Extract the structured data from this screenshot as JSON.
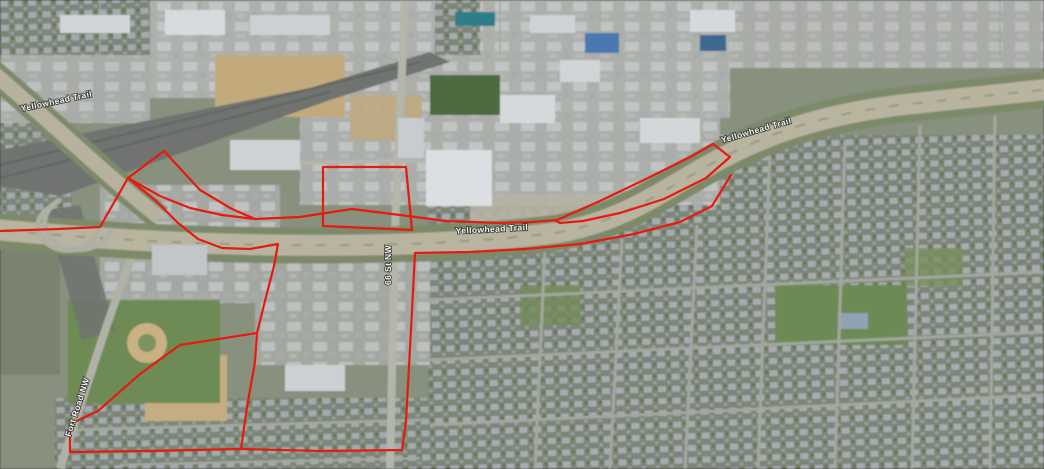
{
  "map": {
    "view_type": "satellite-aerial-oblique",
    "road_labels": [
      {
        "id": "yellowhead-west",
        "text": "Yellowhead Trail",
        "x": 57,
        "y": 104,
        "rot": -12
      },
      {
        "id": "yellowhead-center",
        "text": "Yellowhead Trail",
        "x": 492,
        "y": 232,
        "rot": -3
      },
      {
        "id": "yellowhead-east",
        "text": "Yellowhead Trail",
        "x": 757,
        "y": 133,
        "rot": -16
      },
      {
        "id": "street-vertical",
        "text": "66 St NW",
        "x": 391,
        "y": 265,
        "rot": -90
      },
      {
        "id": "street-diagonal",
        "text": "Fort Road NW",
        "x": 80,
        "y": 408,
        "rot": -72
      }
    ]
  },
  "annotation": {
    "description": "red boundary outline drawn over aerial imagery",
    "color": "#e71a0f",
    "stroke_width": 2.2,
    "paths": [
      {
        "id": "west-approach",
        "points": [
          [
            0,
            231
          ],
          [
            58,
            229
          ],
          [
            100,
            227
          ],
          [
            128,
            178
          ]
        ]
      },
      {
        "id": "wedge-upper-edge",
        "points": [
          [
            128,
            178
          ],
          [
            164,
            151
          ],
          [
            200,
            190
          ],
          [
            232,
            209
          ],
          [
            255,
            219
          ]
        ]
      },
      {
        "id": "wedge-lower-edge",
        "points": [
          [
            128,
            178
          ],
          [
            160,
            196
          ],
          [
            190,
            208
          ],
          [
            222,
            215
          ],
          [
            255,
            219
          ]
        ]
      },
      {
        "id": "north-corridor-east-loop",
        "points": [
          [
            255,
            219
          ],
          [
            300,
            217
          ],
          [
            352,
            209
          ],
          [
            400,
            215
          ],
          [
            446,
            221
          ],
          [
            500,
            223
          ],
          [
            532,
            222
          ],
          [
            557,
            220
          ],
          [
            600,
            201
          ],
          [
            650,
            177
          ],
          [
            692,
            156
          ],
          [
            713,
            144
          ],
          [
            730,
            157
          ],
          [
            706,
            178
          ],
          [
            664,
            199
          ],
          [
            620,
            213
          ],
          [
            583,
            221
          ],
          [
            560,
            223
          ],
          [
            556,
            221
          ]
        ]
      },
      {
        "id": "south-corridor",
        "points": [
          [
            415,
            253
          ],
          [
            470,
            252
          ],
          [
            525,
            249
          ],
          [
            580,
            244
          ],
          [
            634,
            234
          ],
          [
            680,
            222
          ],
          [
            712,
            206
          ],
          [
            731,
            175
          ]
        ]
      },
      {
        "id": "west-block-edge",
        "points": [
          [
            128,
            178
          ],
          [
            156,
            201
          ],
          [
            178,
            223
          ],
          [
            198,
            239
          ],
          [
            222,
            248
          ],
          [
            250,
            249
          ],
          [
            278,
            244
          ],
          [
            274,
            266
          ],
          [
            266,
            297
          ],
          [
            257,
            333
          ]
        ]
      },
      {
        "id": "southwest-parcel",
        "points": [
          [
            257,
            333
          ],
          [
            180,
            345
          ],
          [
            140,
            374
          ],
          [
            98,
            411
          ],
          [
            70,
            424
          ],
          [
            70,
            452
          ],
          [
            150,
            451
          ],
          [
            241,
            449
          ],
          [
            247,
            407
          ],
          [
            255,
            362
          ],
          [
            257,
            333
          ]
        ]
      },
      {
        "id": "south-boundary-loop",
        "points": [
          [
            241,
            449
          ],
          [
            320,
            451
          ],
          [
            402,
            450
          ],
          [
            406,
            421
          ],
          [
            411,
            330
          ],
          [
            415,
            253
          ]
        ]
      },
      {
        "id": "north-rectangle",
        "points": [
          [
            323,
            226
          ],
          [
            323,
            167
          ],
          [
            406,
            167
          ],
          [
            412,
            230
          ],
          [
            323,
            226
          ]
        ]
      }
    ]
  }
}
